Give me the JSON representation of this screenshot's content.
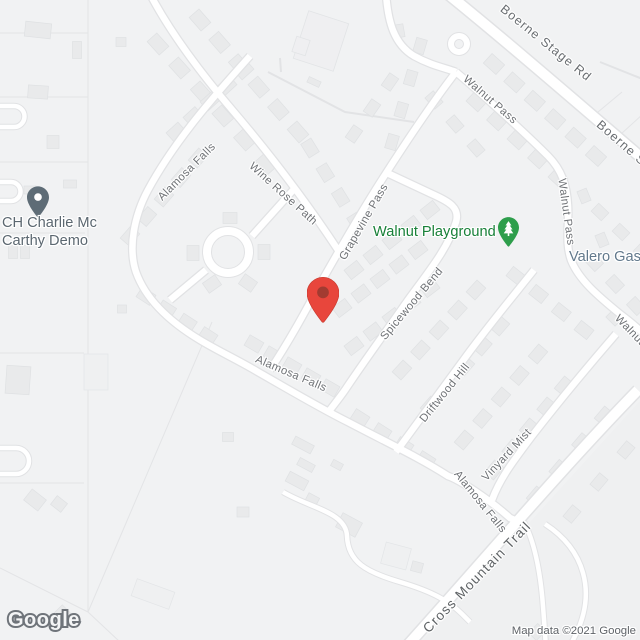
{
  "map": {
    "watermark": "Google",
    "attribution": "Map data ©2021 Google",
    "colors": {
      "background": "#F1F2F3",
      "road_fill": "#FFFFFF",
      "road_casing": "#E1E2E4",
      "building": "#E9EAEB",
      "marker_red": "#E8463C",
      "marker_red_dot": "#A23B31",
      "poi_default_pin": "#5E6C76",
      "poi_park_pin": "#2E9E4B",
      "poi_park_text": "#188038",
      "poi_gas_text": "#62798C",
      "road_label_text": "#6F7276"
    },
    "pois": {
      "charlie": {
        "line1": "CH Charlie Mc",
        "line2": "Carthy Demo"
      },
      "playground": {
        "label": "Walnut Playground"
      },
      "valero": {
        "label": "Valero Gas"
      }
    },
    "road_labels": [
      {
        "id": "boerne-stage-rd",
        "text": "Boerne Stage Rd",
        "x": 546,
        "y": 43,
        "rot": 39,
        "cls": "major"
      },
      {
        "id": "boerne-stage-rd-2",
        "text": "Boerne Stage Rd",
        "x": 641,
        "y": 160,
        "rot": 41,
        "cls": "major"
      },
      {
        "id": "walnut-pass-1",
        "text": "Walnut Pass",
        "x": 490,
        "y": 100,
        "rot": 41,
        "cls": ""
      },
      {
        "id": "walnut-pass-2",
        "text": "Walnut Pass",
        "x": 566,
        "y": 212,
        "rot": 82,
        "cls": ""
      },
      {
        "id": "walnut-pass-3",
        "text": "Walnut Pass",
        "x": 640,
        "y": 341,
        "rot": 46,
        "cls": ""
      },
      {
        "id": "alamosa-falls-1",
        "text": "Alamosa Falls",
        "x": 187,
        "y": 172,
        "rot": -45,
        "cls": ""
      },
      {
        "id": "wine-rose-path",
        "text": "Wine Rose Path",
        "x": 283,
        "y": 194,
        "rot": 42,
        "cls": ""
      },
      {
        "id": "grapevine-pass",
        "text": "Grapevine Pass",
        "x": 364,
        "y": 222,
        "rot": -60,
        "cls": ""
      },
      {
        "id": "spicewood-bend",
        "text": "Spicewood Bend",
        "x": 412,
        "y": 304,
        "rot": -50,
        "cls": ""
      },
      {
        "id": "driftwood-hill",
        "text": "Driftwood Hill",
        "x": 445,
        "y": 393,
        "rot": -51,
        "cls": ""
      },
      {
        "id": "alamosa-falls-2",
        "text": "Alamosa Falls",
        "x": 291,
        "y": 374,
        "rot": 23,
        "cls": ""
      },
      {
        "id": "alamosa-falls-3",
        "text": "Alamosa Falls",
        "x": 480,
        "y": 502,
        "rot": 51,
        "cls": ""
      },
      {
        "id": "vinyard-mist",
        "text": "Vinyard Mist",
        "x": 507,
        "y": 455,
        "rot": -47,
        "cls": ""
      },
      {
        "id": "cross-mountain-trail",
        "text": "Cross Mountain Trail",
        "x": 477,
        "y": 577,
        "rot": -46,
        "cls": "trunk"
      }
    ]
  }
}
